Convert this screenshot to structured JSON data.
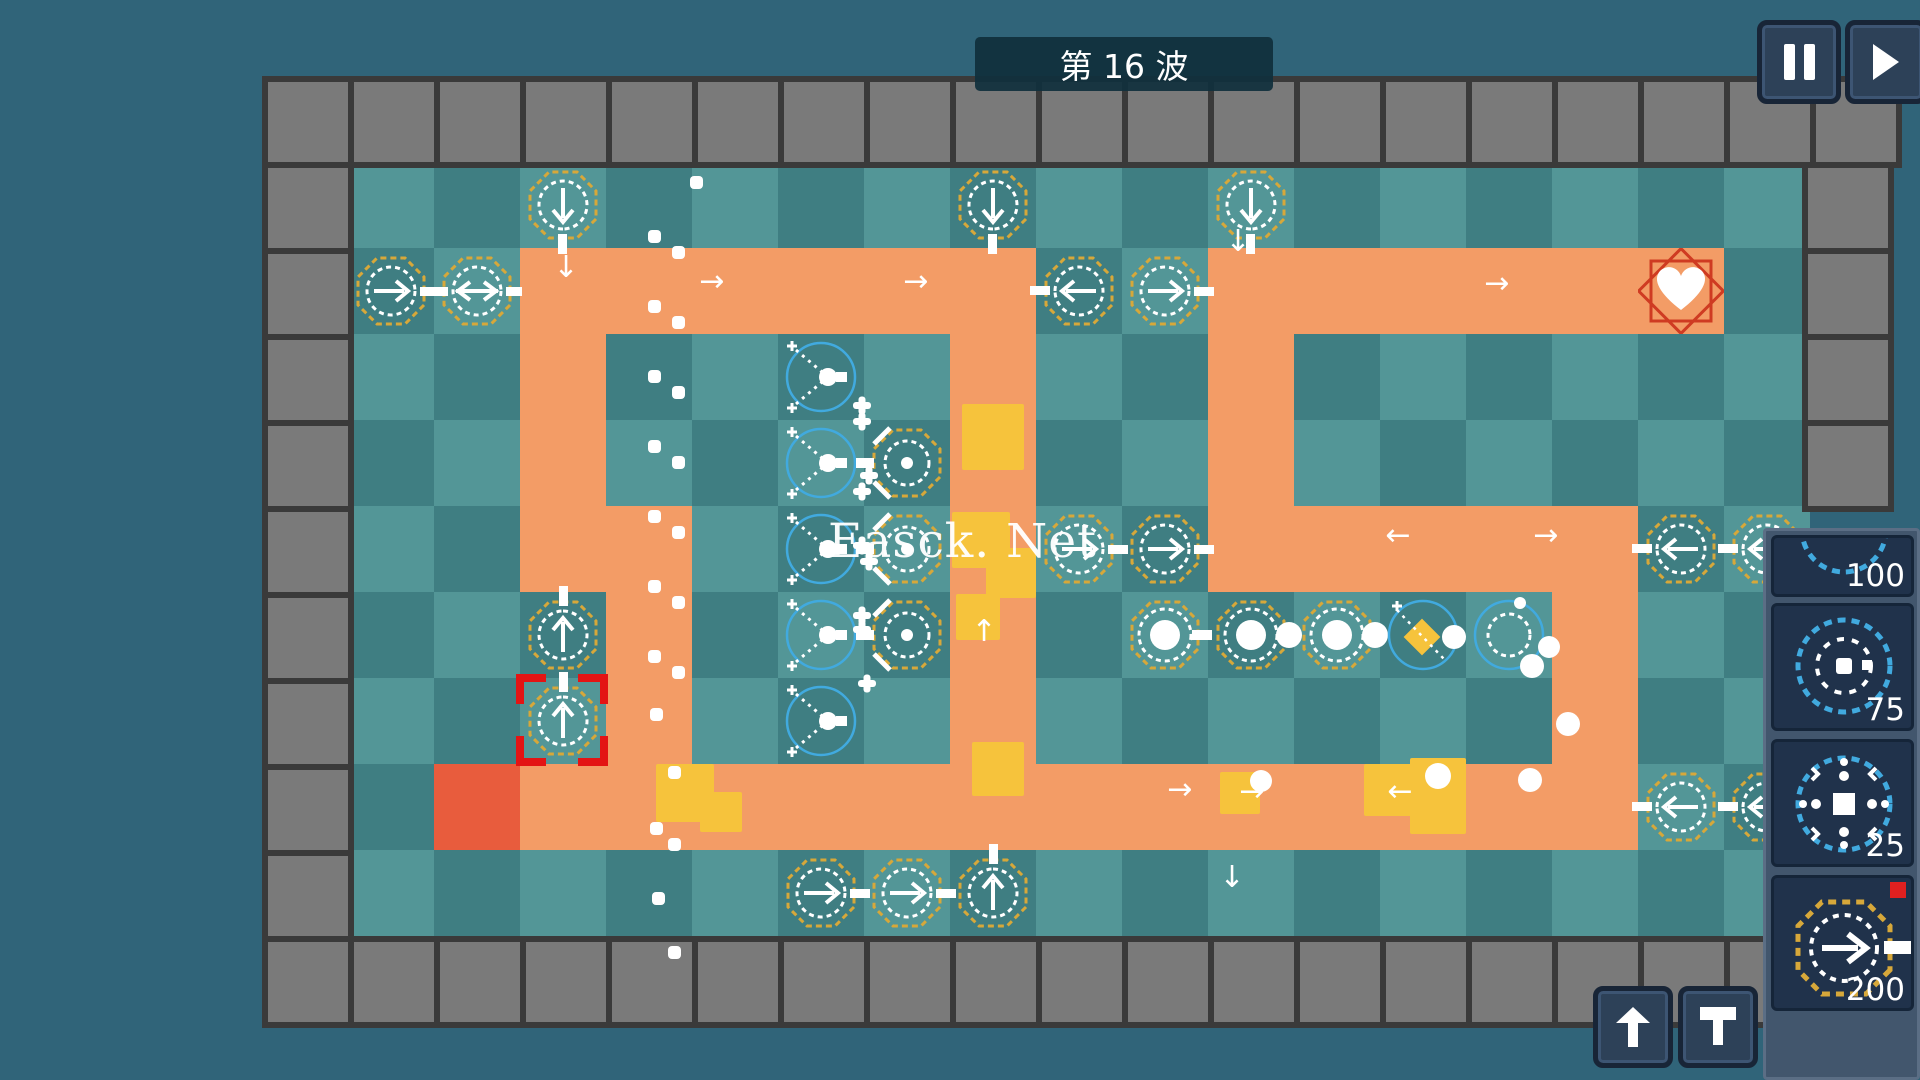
{
  "hud": {
    "wave_label": "第 16 波",
    "pause_icon": "pause-icon",
    "fast_forward_icon": "fast-forward-icon",
    "upgrade_icon": "upgrade-arrow-icon",
    "sell_icon": "sell-icon"
  },
  "watermark": {
    "text": "Easck. Net"
  },
  "sidebar": {
    "cards": [
      {
        "price": "100",
        "icon": "blue-circle-tower-icon"
      },
      {
        "price": "75",
        "icon": "rotor-tower-icon"
      },
      {
        "price": "25",
        "icon": "burst-tower-icon"
      },
      {
        "price": "200",
        "icon": "arrow-tower-icon",
        "badge": true
      }
    ]
  },
  "colors": {
    "background": "#306479",
    "tile_light": "#539697",
    "tile_dark": "#3f7e82",
    "path": "#f39c66",
    "spawn": "#e85c3d",
    "enemy": "#f6c33c",
    "octagon": "#d7a83a",
    "blue": "#41aadf",
    "select": "#e31414",
    "heart_frame": "#cf3b22",
    "wall": "#7a7a7a"
  },
  "board": {
    "origin": [
      348,
      162
    ],
    "tile": 86,
    "cols": 17,
    "rows": 9,
    "spawn": [
      1,
      7
    ],
    "heart": [
      15,
      1
    ],
    "selected": [
      2,
      6
    ],
    "path": [
      [
        2,
        1
      ],
      [
        3,
        1
      ],
      [
        4,
        1
      ],
      [
        5,
        1
      ],
      [
        6,
        1
      ],
      [
        7,
        1
      ],
      [
        10,
        1
      ],
      [
        11,
        1
      ],
      [
        12,
        1
      ],
      [
        13,
        1
      ],
      [
        14,
        1
      ],
      [
        15,
        1
      ],
      [
        2,
        2
      ],
      [
        2,
        3
      ],
      [
        2,
        4
      ],
      [
        3,
        4
      ],
      [
        3,
        5
      ],
      [
        3,
        6
      ],
      [
        7,
        2
      ],
      [
        7,
        3
      ],
      [
        7,
        4
      ],
      [
        7,
        5
      ],
      [
        7,
        6
      ],
      [
        10,
        2
      ],
      [
        10,
        3
      ],
      [
        10,
        4
      ],
      [
        11,
        4
      ],
      [
        12,
        4
      ],
      [
        13,
        4
      ],
      [
        14,
        4
      ],
      [
        14,
        5
      ],
      [
        14,
        6
      ],
      [
        2,
        7
      ],
      [
        3,
        7
      ],
      [
        4,
        7
      ],
      [
        5,
        7
      ],
      [
        6,
        7
      ],
      [
        7,
        7
      ],
      [
        8,
        7
      ],
      [
        9,
        7
      ],
      [
        10,
        7
      ],
      [
        11,
        7
      ],
      [
        12,
        7
      ],
      [
        13,
        7
      ],
      [
        14,
        7
      ]
    ],
    "towers": [
      {
        "c": 2,
        "r": 0,
        "t": "arrow",
        "d": "down"
      },
      {
        "c": 7,
        "r": 0,
        "t": "arrow",
        "d": "down"
      },
      {
        "c": 10,
        "r": 0,
        "t": "arrow",
        "d": "down"
      },
      {
        "c": 0,
        "r": 1,
        "t": "arrow",
        "d": "right"
      },
      {
        "c": 1,
        "r": 1,
        "t": "arrow",
        "d": "both"
      },
      {
        "c": 8,
        "r": 1,
        "t": "arrow",
        "d": "left"
      },
      {
        "c": 9,
        "r": 1,
        "t": "arrow",
        "d": "right"
      },
      {
        "c": 5,
        "r": 2,
        "t": "ybeam"
      },
      {
        "c": 5,
        "r": 3,
        "t": "ybeam"
      },
      {
        "c": 5,
        "r": 4,
        "t": "ybeam"
      },
      {
        "c": 5,
        "r": 5,
        "t": "ybeam"
      },
      {
        "c": 5,
        "r": 6,
        "t": "ybeam"
      },
      {
        "c": 6,
        "r": 3,
        "t": "vgun"
      },
      {
        "c": 6,
        "r": 4,
        "t": "vgun"
      },
      {
        "c": 6,
        "r": 5,
        "t": "vgun"
      },
      {
        "c": 8,
        "r": 4,
        "t": "arrow",
        "d": "right"
      },
      {
        "c": 9,
        "r": 4,
        "t": "arrow",
        "d": "right"
      },
      {
        "c": 9,
        "r": 5,
        "t": "cannon",
        "d": "rect"
      },
      {
        "c": 10,
        "r": 5,
        "t": "cannon",
        "d": "ball"
      },
      {
        "c": 11,
        "r": 5,
        "t": "cannon",
        "d": "ball"
      },
      {
        "c": 12,
        "r": 5,
        "t": "bluediamond"
      },
      {
        "c": 13,
        "r": 5,
        "t": "bluering"
      },
      {
        "c": 2,
        "r": 5,
        "t": "arrow",
        "d": "up"
      },
      {
        "c": 2,
        "r": 6,
        "t": "arrow",
        "d": "up",
        "sel": true
      },
      {
        "c": 5,
        "r": 8,
        "t": "arrow",
        "d": "right"
      },
      {
        "c": 6,
        "r": 8,
        "t": "arrow",
        "d": "right"
      },
      {
        "c": 7,
        "r": 8,
        "t": "arrow",
        "d": "up"
      },
      {
        "c": 15,
        "r": 4,
        "t": "arrow",
        "d": "left"
      },
      {
        "c": 16,
        "r": 4,
        "t": "arrow",
        "d": "left"
      },
      {
        "c": 15,
        "r": 7,
        "t": "arrow",
        "d": "left"
      },
      {
        "c": 16,
        "r": 7,
        "t": "arrow",
        "d": "left"
      }
    ],
    "enemies": [
      {
        "x": 962,
        "y": 404,
        "w": 62,
        "h": 66
      },
      {
        "x": 952,
        "y": 512,
        "w": 58,
        "h": 56
      },
      {
        "x": 986,
        "y": 548,
        "w": 50,
        "h": 50
      },
      {
        "x": 956,
        "y": 594,
        "w": 44,
        "h": 46
      },
      {
        "x": 972,
        "y": 742,
        "w": 52,
        "h": 54
      },
      {
        "x": 656,
        "y": 764,
        "w": 58,
        "h": 58
      },
      {
        "x": 700,
        "y": 792,
        "w": 42,
        "h": 40
      },
      {
        "x": 1220,
        "y": 772,
        "w": 40,
        "h": 42
      },
      {
        "x": 1364,
        "y": 764,
        "w": 48,
        "h": 52
      },
      {
        "x": 1410,
        "y": 758,
        "w": 56,
        "h": 76
      }
    ],
    "balls": [
      {
        "x": 1425,
        "y": 763,
        "r": 13
      },
      {
        "x": 1518,
        "y": 768,
        "r": 12
      },
      {
        "x": 1250,
        "y": 770,
        "r": 11
      },
      {
        "x": 1556,
        "y": 712,
        "r": 12
      },
      {
        "x": 1538,
        "y": 636,
        "r": 11
      },
      {
        "x": 1520,
        "y": 654,
        "r": 12
      }
    ],
    "dots": [
      [
        690,
        176
      ],
      [
        648,
        230
      ],
      [
        672,
        246
      ],
      [
        648,
        300
      ],
      [
        672,
        316
      ],
      [
        648,
        370
      ],
      [
        672,
        386
      ],
      [
        648,
        440
      ],
      [
        672,
        456
      ],
      [
        648,
        510
      ],
      [
        672,
        526
      ],
      [
        648,
        580
      ],
      [
        672,
        596
      ],
      [
        648,
        650
      ],
      [
        672,
        666
      ],
      [
        650,
        708
      ],
      [
        668,
        766
      ],
      [
        650,
        822
      ],
      [
        668,
        838
      ],
      [
        652,
        892
      ],
      [
        668,
        946
      ]
    ],
    "asterisks": [
      [
        853,
        396
      ],
      [
        853,
        412
      ],
      [
        860,
        466
      ],
      [
        853,
        482
      ],
      [
        853,
        536
      ],
      [
        860,
        552
      ],
      [
        853,
        606
      ],
      [
        853,
        620
      ],
      [
        858,
        674
      ]
    ],
    "arrows": [
      {
        "x": 566,
        "y": 268,
        "g": "↓"
      },
      {
        "x": 712,
        "y": 282,
        "g": "→"
      },
      {
        "x": 916,
        "y": 282,
        "g": "→"
      },
      {
        "x": 1497,
        "y": 284,
        "g": "→"
      },
      {
        "x": 1238,
        "y": 242,
        "g": "↓"
      },
      {
        "x": 1398,
        "y": 536,
        "g": "←"
      },
      {
        "x": 1546,
        "y": 536,
        "g": "→"
      },
      {
        "x": 984,
        "y": 632,
        "g": "↑"
      },
      {
        "x": 1180,
        "y": 790,
        "g": "→"
      },
      {
        "x": 1252,
        "y": 792,
        "g": "→"
      },
      {
        "x": 1400,
        "y": 792,
        "g": "←"
      },
      {
        "x": 1232,
        "y": 878,
        "g": "↓"
      }
    ]
  }
}
